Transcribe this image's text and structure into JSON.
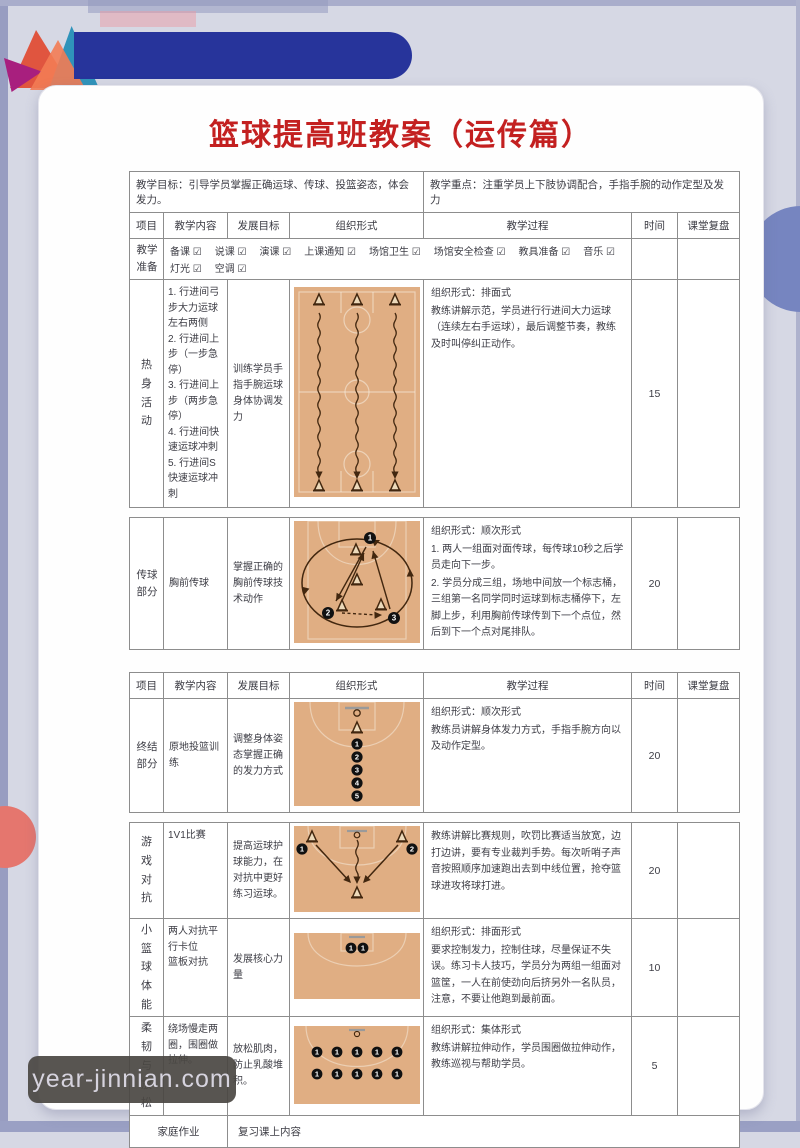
{
  "title": "篮球提高班教案（运传篇）",
  "watermark": "year-jinnian.com",
  "meta": {
    "objective": "教学目标：引导学员掌握正确运球、传球、投篮姿态，体会发力。",
    "focus": "教学重点：注重学员上下肢协调配合，手指手腕的动作定型及发力"
  },
  "columns": {
    "project": "项目",
    "content": "教学内容",
    "goal": "发展目标",
    "organization": "组织形式",
    "process": "教学过程",
    "time": "时间",
    "review": "课堂复盘"
  },
  "prep": {
    "label": "教学准备",
    "items": [
      "备课 ☑",
      "说课 ☑",
      "演课 ☑",
      "上课通知 ☑",
      "场馆卫生 ☑",
      "场馆安全检查 ☑",
      "教具准备 ☑",
      "音乐 ☑",
      "灯光 ☑",
      "空调 ☑"
    ]
  },
  "sections": {
    "warmup": {
      "label": "热身活动",
      "content": [
        "1.  行进间弓步大力运球左右两侧",
        "2.  行进间上步（一步急停）",
        "3.  行进间上步（两步急停）",
        "4.  行进间快速运球冲刺",
        "5.  行进间S快速运球冲刺"
      ],
      "goal": "训练学员手指手腕运球身体协调发力",
      "process": [
        "组织形式：排面式",
        "教练讲解示范，学员进行行进间大力运球（连续左右手运球），最后调整节奏，教练及时叫停纠正动作。"
      ],
      "time": "15"
    },
    "passing": {
      "label": "传球部分",
      "content": "胸前传球",
      "goal": "掌握正确的胸前传球技术动作",
      "process": [
        "组织形式：顺次形式",
        "1.  两人一组面对面传球，每传球10秒之后学员走向下一步。",
        "2.  学员分成三组，场地中间放一个标志桶，三组第一名同学同时运球到标志桶停下，左脚上步，利用胸前传球传到下一个点位，然后到下一个点对尾排队。"
      ],
      "time": "20"
    },
    "ending": {
      "label": "终结部分",
      "content": "原地投篮训练",
      "goal": "调整身体姿态掌握正确的发力方式",
      "process": [
        "组织形式：顺次形式",
        "教练员讲解身体发力方式，手指手腕方向以及动作定型。"
      ],
      "time": "20"
    },
    "game": {
      "label": "游戏对抗",
      "content": "1V1比赛",
      "goal": "提高运球护球能力，在对抗中更好练习运球。",
      "process": [
        "教练讲解比赛规则，吹罚比赛适当放宽，边打边讲，要有专业裁判手势。每次听哨子声音按照顺序加速跑出去到中线位置，抢夺篮球进攻将球打进。"
      ],
      "time": "20"
    },
    "fitness": {
      "label": "小篮球体能",
      "content": [
        "两人对抗平行卡位",
        "篮板对抗"
      ],
      "goal": "发展核心力量",
      "process": [
        "组织形式：排面形式",
        "要求控制发力，控制住球，尽量保证不失误。练习卡人技巧，学员分为两组一组面对篮筐，一人在前使劲向后挤另外一名队员，注意，不要让他跑到最前面。"
      ],
      "time": "10"
    },
    "relax": {
      "label": "柔韧与放松",
      "content": "绕场慢走两圈，围圈做拉伸。",
      "goal": "放松肌肉，防止乳酸堆积。",
      "process": [
        "组织形式：集体形式",
        "教练讲解拉伸动作，学员围圈做拉伸动作，教练巡视与帮助学员。"
      ],
      "time": "5"
    }
  },
  "homework": {
    "label": "家庭作业",
    "value": "复习课上内容"
  },
  "colors": {
    "title_red": "#c32020",
    "accent_blue": "#27349b",
    "court_tan": "#e0ae83",
    "page_bg": "#d6d8e4",
    "circle_right": "#7685c0",
    "circle_left": "#e5766e"
  }
}
